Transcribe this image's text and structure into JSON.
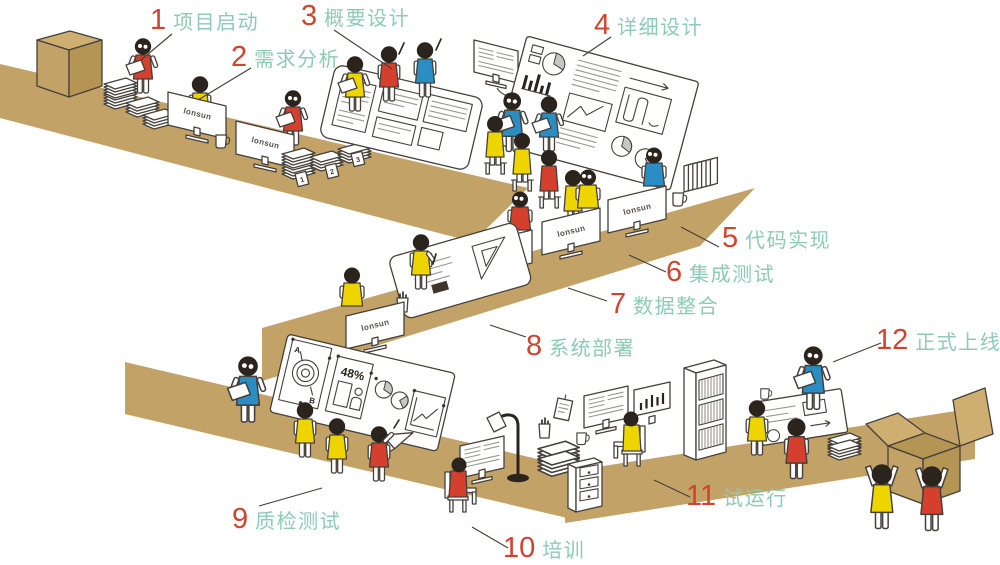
{
  "steps": [
    {
      "num": "1",
      "label": "项目启动"
    },
    {
      "num": "2",
      "label": "需求分析"
    },
    {
      "num": "3",
      "label": "概要设计"
    },
    {
      "num": "4",
      "label": "详细设计"
    },
    {
      "num": "5",
      "label": "代码实现"
    },
    {
      "num": "6",
      "label": "集成测试"
    },
    {
      "num": "7",
      "label": "数据整合"
    },
    {
      "num": "8",
      "label": "系统部署"
    },
    {
      "num": "9",
      "label": "质检测试"
    },
    {
      "num": "10",
      "label": "培训"
    },
    {
      "num": "11",
      "label": "试运行"
    },
    {
      "num": "12",
      "label": "正式上线"
    }
  ],
  "monitor_brand": "lonsun",
  "board_annotations": {
    "percent": "48%",
    "point_a": "A",
    "point_b": "B"
  },
  "stack_tags": [
    "1",
    "2",
    "3"
  ],
  "colors": {
    "step_number": "#d0432f",
    "step_label": "#8ecab6",
    "desk": "#c3a268",
    "shirt_red": "#d5402e",
    "shirt_yellow": "#efd500",
    "shirt_blue": "#2a8dc4"
  }
}
